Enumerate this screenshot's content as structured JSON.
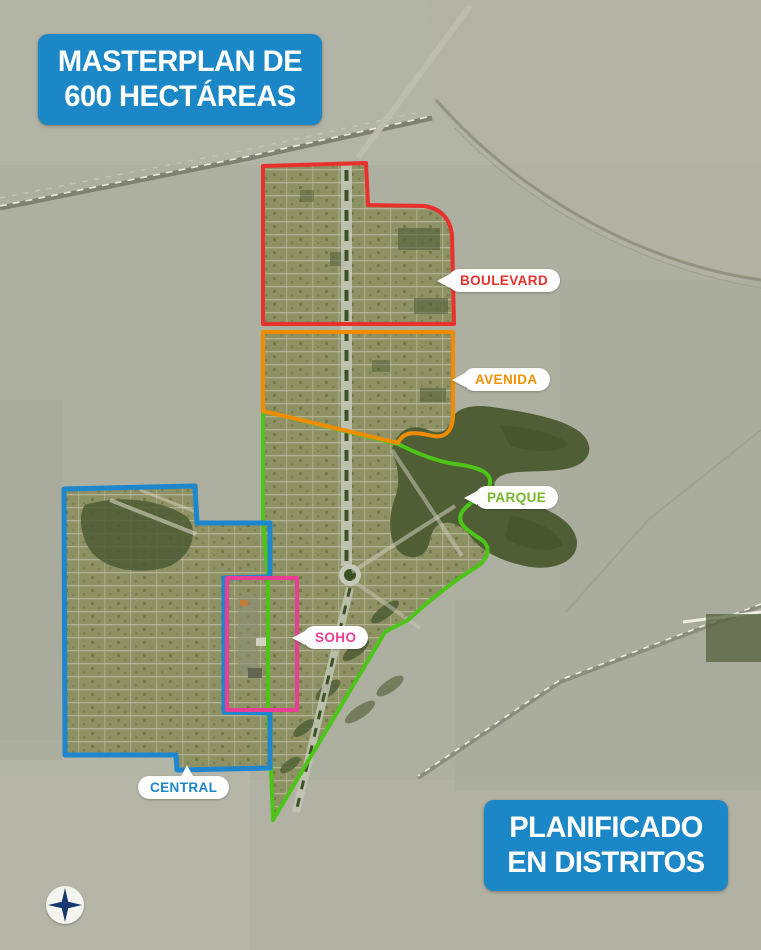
{
  "title_badge": {
    "line1": "MASTERPLAN DE",
    "line2": "600 HECTÁREAS"
  },
  "footer_badge": {
    "line1": "PLANIFICADO",
    "line2": "EN DISTRITOS"
  },
  "districts": [
    {
      "id": "boulevard",
      "label": "BOULEVARD",
      "color": "#e8312c"
    },
    {
      "id": "avenida",
      "label": "AVENIDA",
      "color": "#f29100"
    },
    {
      "id": "parque",
      "label": "PARQUE",
      "color": "#76b82a"
    },
    {
      "id": "soho",
      "label": "SOHO",
      "color": "#ea3e96"
    },
    {
      "id": "central",
      "label": "CENTRAL",
      "color": "#1c86c8"
    }
  ],
  "colors": {
    "badge_blue": "#1b87c6",
    "outline_red": "#e8312c",
    "outline_orange": "#f08c00",
    "outline_green": "#4cc418",
    "outline_blue": "#1e86cc",
    "outline_pink": "#ea3e96",
    "parcel_green": "#8e9164",
    "park_dark_green": "#505e35",
    "basemap_gray": "#adafa1"
  },
  "icons": {
    "compass": "compass-rose"
  }
}
